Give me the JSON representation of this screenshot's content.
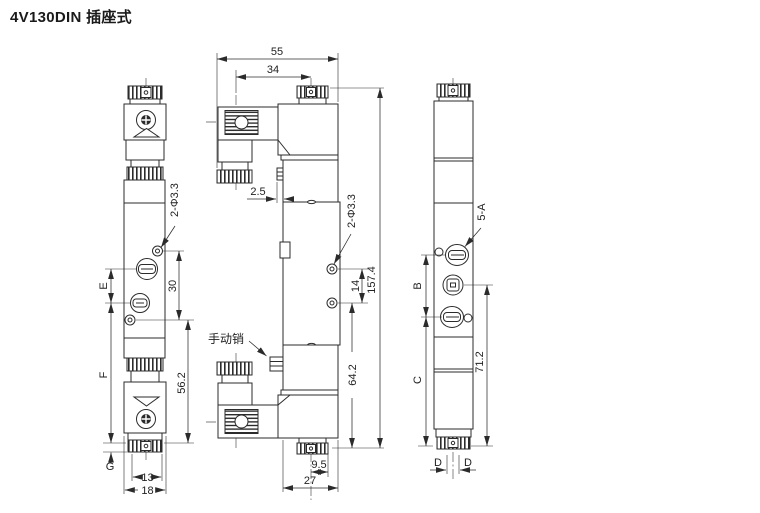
{
  "title": "4V130DIN 插座式",
  "front_view": {
    "holes_label": "2-Φ3.3",
    "dim_e": "E",
    "dim_f": "F",
    "dim_g": "G",
    "dim_port_pitch": "30",
    "dim_lower_height": "56.2",
    "dim_cap_width": "13",
    "dim_body_width": "18"
  },
  "side_view": {
    "dim_overall_width": "55",
    "dim_connector_offset": "34",
    "dim_tab_offset": "2.5",
    "holes_label": "2-Φ3.3",
    "dim_overall_height": "157.4",
    "dim_hole_pitch": "14",
    "dim_lower_height": "64.2",
    "manual_pin_label": "手动销",
    "dim_cap_offset": "9.5",
    "dim_body_depth": "27"
  },
  "end_view": {
    "port_label": "5-A",
    "dim_b": "B",
    "dim_c": "C",
    "dim_height": "71.2",
    "dim_d_left": "D",
    "dim_d_right": "D"
  },
  "colors": {
    "line": "#2b2b2b",
    "background": "#ffffff"
  }
}
